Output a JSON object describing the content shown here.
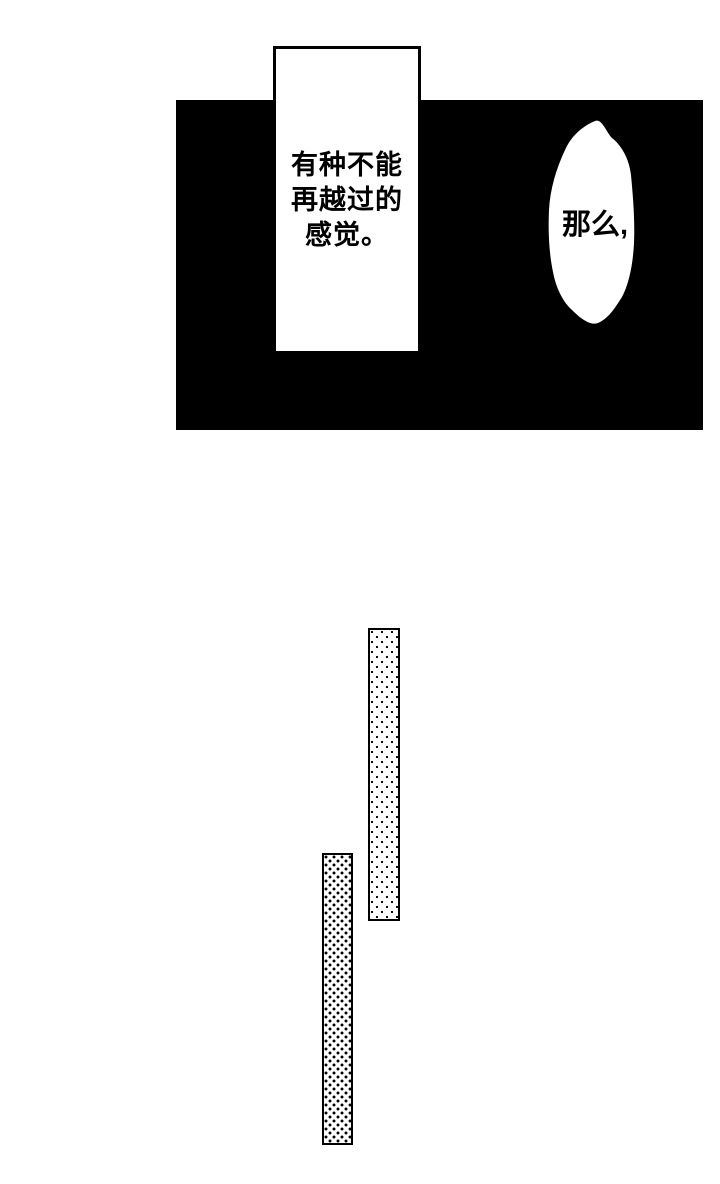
{
  "page": {
    "type": "manga-page",
    "width": 720,
    "height": 1184,
    "colors": {
      "paper": "#ffffff",
      "ink": "#000000"
    }
  },
  "panel": {
    "background_color": "#000000",
    "caption": {
      "text": "有种不能\n再越过的\n感觉。"
    },
    "bubble": {
      "text": "那么,",
      "fill_color": "#ffffff"
    }
  },
  "screentones": {
    "tall_bar": {
      "pattern": "small-dot-halftone"
    },
    "short_bar": {
      "pattern": "large-dot-halftone"
    }
  }
}
